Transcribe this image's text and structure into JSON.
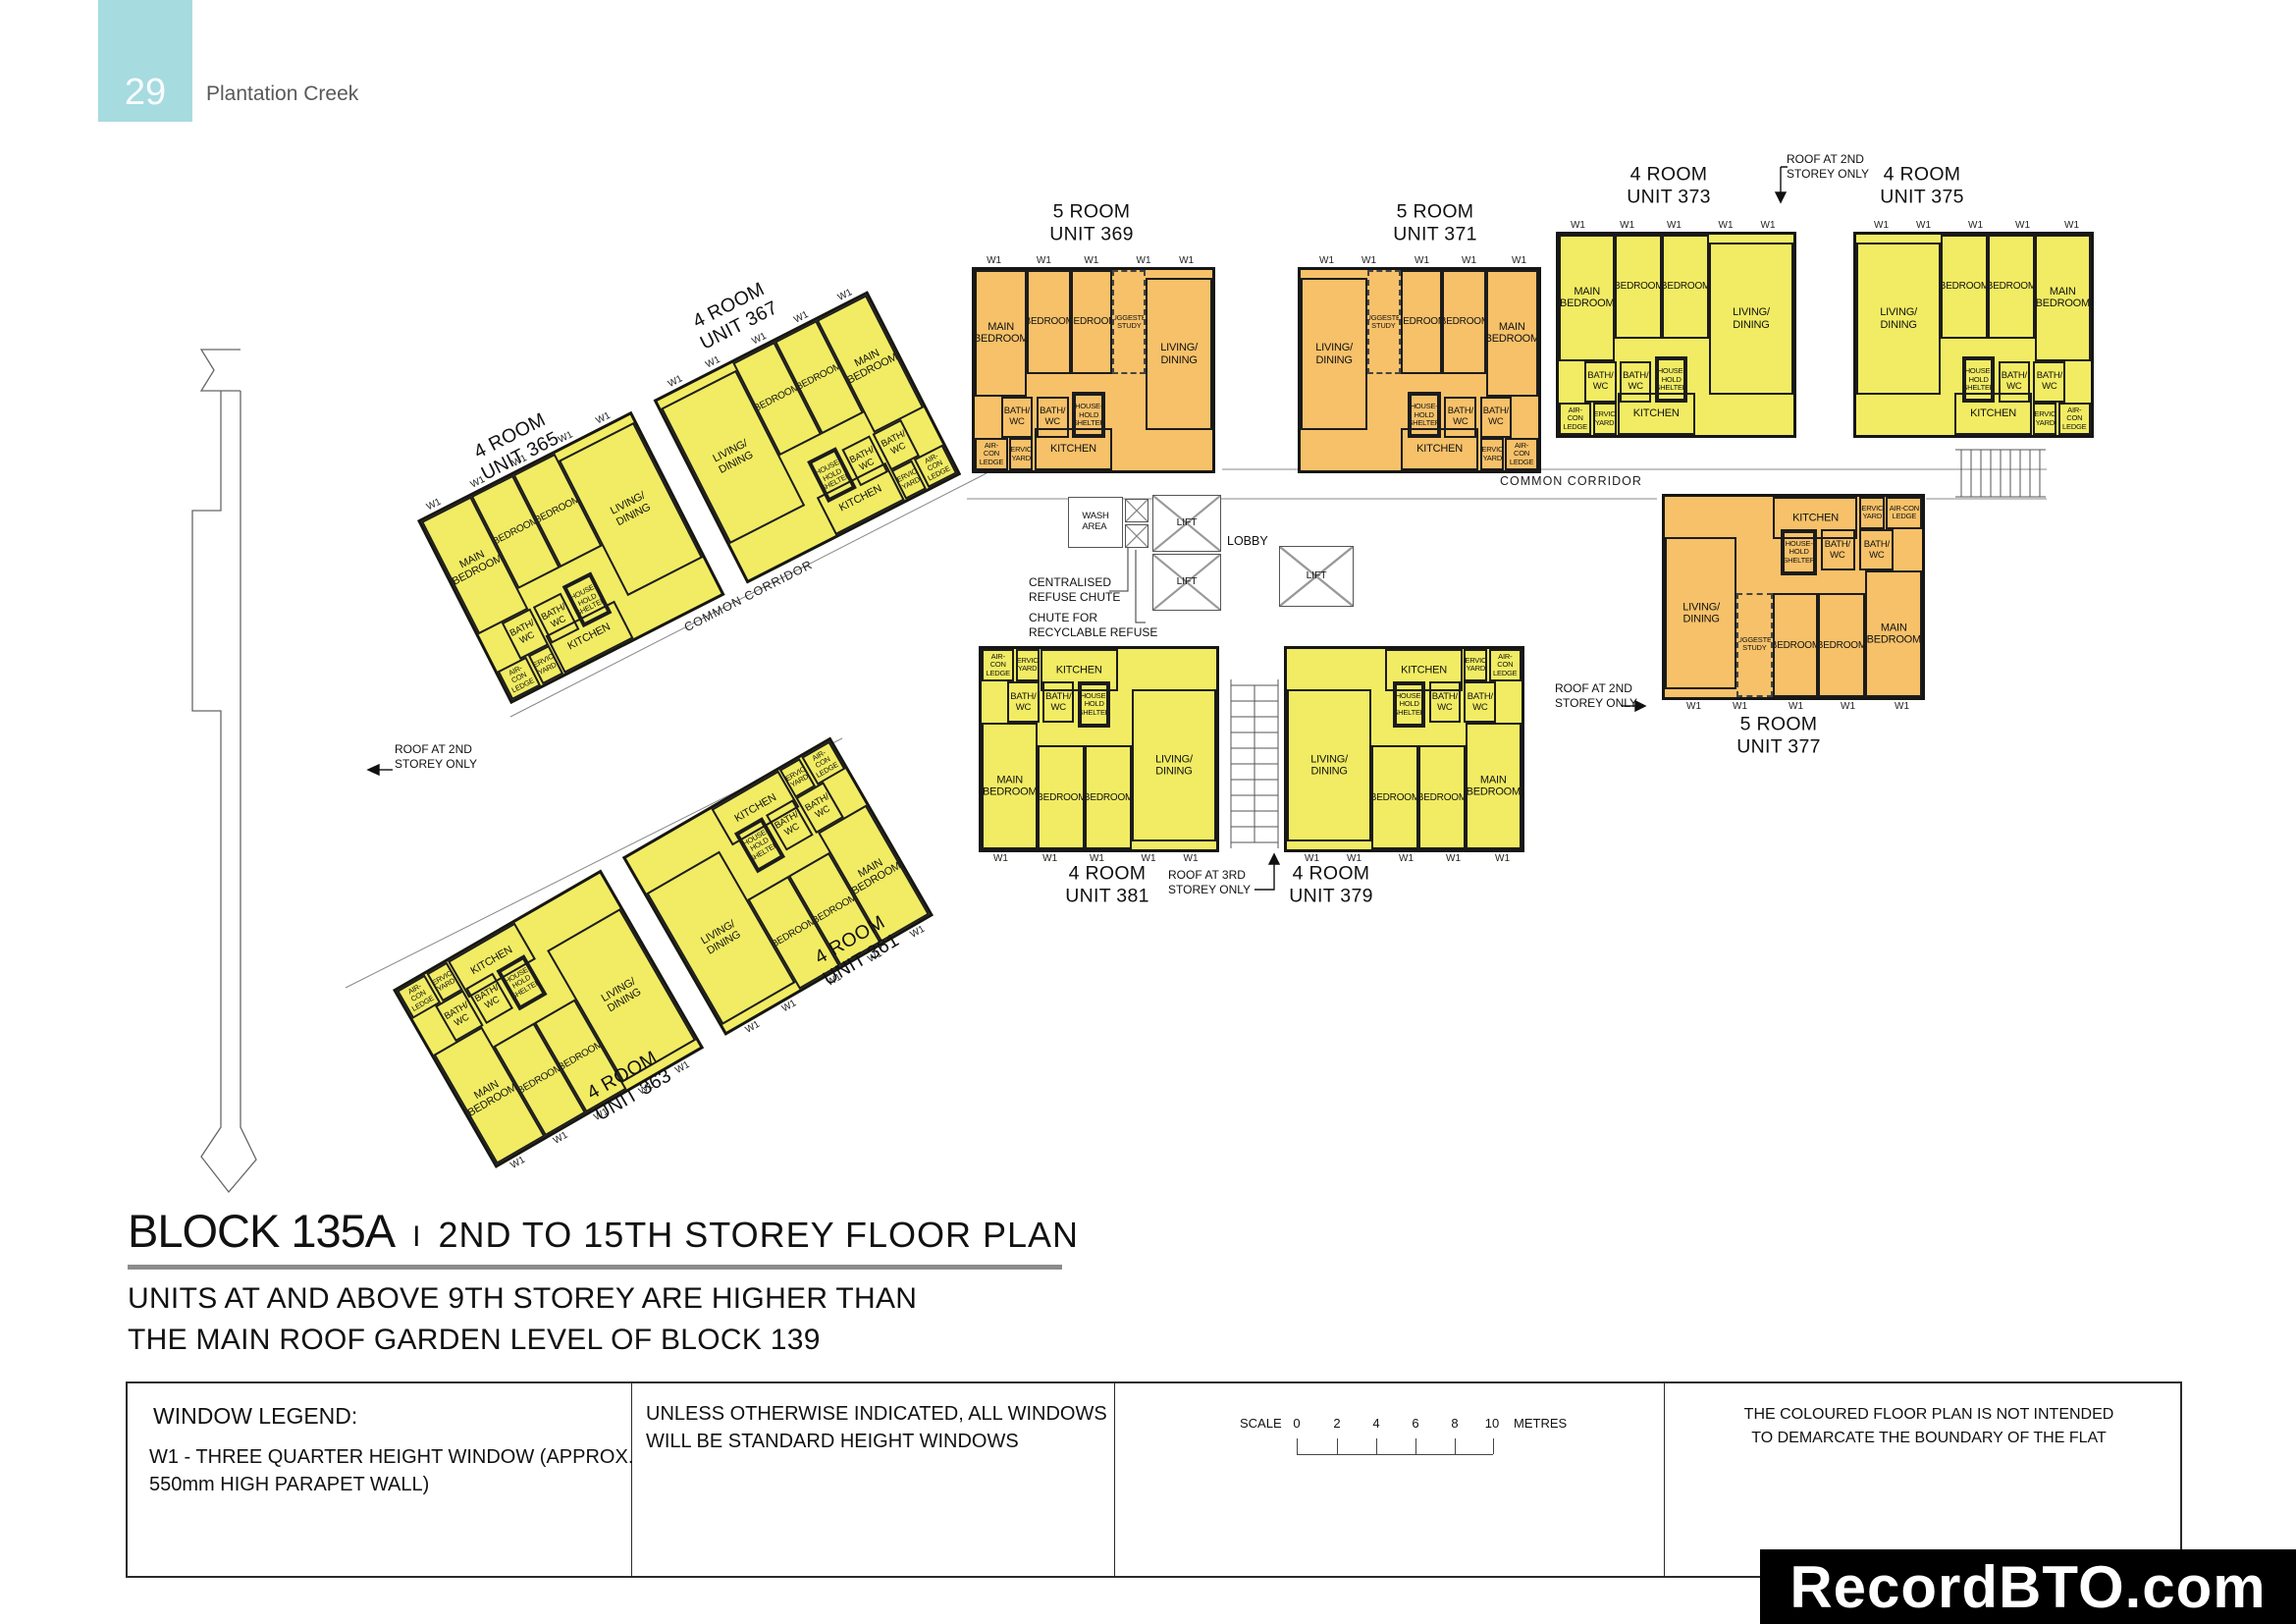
{
  "header": {
    "page_number": "29",
    "project_name": "Plantation Creek"
  },
  "rooms": {
    "main_bedroom": "MAIN\nBEDROOM",
    "bedroom": "BEDROOM",
    "living": "LIVING/\nDINING",
    "kitchen": "KITCHEN",
    "bath": "BATH/\nWC",
    "shelter": "HOUSE-\nHOLD\nSHELTER",
    "study": "SUGGESTED\nSTUDY",
    "aircon": "AIR-CON\nLEDGE",
    "service": "SERVICE\nYARD",
    "window": "W1"
  },
  "units": {
    "u361": {
      "type": "4 ROOM",
      "no": "UNIT 361"
    },
    "u363": {
      "type": "4 ROOM",
      "no": "UNIT 363"
    },
    "u365": {
      "type": "4 ROOM",
      "no": "UNIT 365"
    },
    "u367": {
      "type": "4 ROOM",
      "no": "UNIT 367"
    },
    "u369": {
      "type": "5 ROOM",
      "no": "UNIT 369"
    },
    "u371": {
      "type": "5 ROOM",
      "no": "UNIT 371"
    },
    "u373": {
      "type": "4 ROOM",
      "no": "UNIT 373"
    },
    "u375": {
      "type": "4 ROOM",
      "no": "UNIT 375"
    },
    "u377": {
      "type": "5 ROOM",
      "no": "UNIT 377"
    },
    "u379": {
      "type": "4 ROOM",
      "no": "UNIT 379"
    },
    "u381": {
      "type": "4 ROOM",
      "no": "UNIT 381"
    }
  },
  "core": {
    "wash": "WASH\nAREA",
    "lift": "LIFT",
    "lobby": "LOBBY",
    "refuse_chute": "CENTRALISED\nREFUSE CHUTE",
    "recycle_chute": "CHUTE FOR\nRECYCLABLE REFUSE",
    "corridor": "COMMON CORRIDOR"
  },
  "annotations": {
    "roof2": "ROOF AT 2ND\nSTOREY ONLY",
    "roof3": "ROOF AT 3RD\nSTOREY ONLY"
  },
  "footer": {
    "block": "BLOCK 135A",
    "divider": "I",
    "plan_title": "2ND TO 15TH STOREY FLOOR PLAN",
    "note1": "UNITS AT AND ABOVE 9TH STOREY ARE HIGHER THAN",
    "note2": "THE MAIN ROOF GARDEN LEVEL OF BLOCK 139"
  },
  "legend": {
    "heading": "WINDOW LEGEND:",
    "w1_line1": "W1  -  THREE QUARTER HEIGHT WINDOW (APPROX.",
    "w1_line2": "550mm HIGH PARAPET WALL)",
    "note_line1": "UNLESS OTHERWISE INDICATED,  ALL WINDOWS",
    "note_line2": "WILL BE STANDARD HEIGHT WINDOWS",
    "scale_label": "SCALE",
    "scale_ticks": [
      "0",
      "2",
      "4",
      "6",
      "8",
      "10"
    ],
    "scale_unit": "METRES",
    "disclaimer_line1": "THE COLOURED FLOOR PLAN IS NOT INTENDED",
    "disclaimer_line2": "TO DEMARCATE THE BOUNDARY OF THE FLAT"
  },
  "watermark": "RecordBTO.com",
  "colors": {
    "four_room": "#f1ec63",
    "five_room": "#f6c169",
    "tab_blue": "#a6dbe0",
    "wall": "#161616"
  }
}
